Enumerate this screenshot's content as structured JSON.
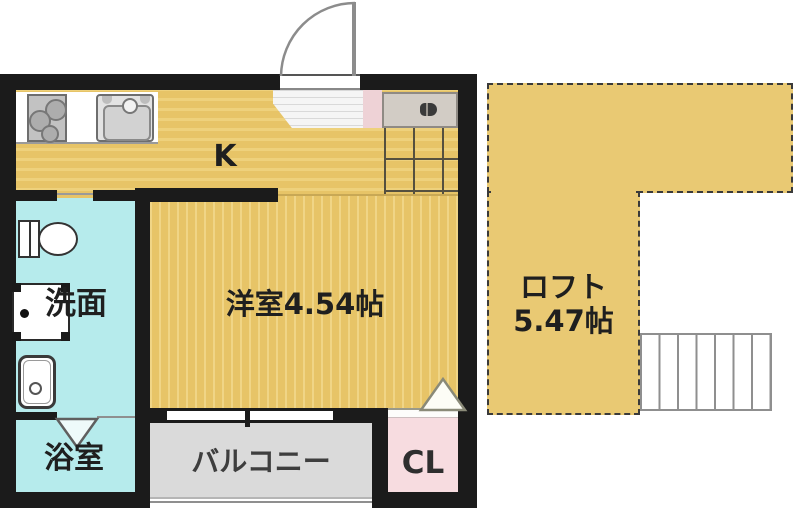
{
  "rooms": {
    "kitchen": {
      "label": "K"
    },
    "main_room": {
      "label": "洋室4.54帖"
    },
    "loft": {
      "label_line1": "ロフト",
      "label_line2": "5.47帖"
    },
    "washroom": {
      "label": "洗面"
    },
    "bathroom": {
      "label": "浴室"
    },
    "balcony": {
      "label": "バルコニー"
    },
    "closet": {
      "label": "CL"
    }
  },
  "icons": {
    "stove": "three-burner-circles",
    "sink": "rounded-basin-with-faucet",
    "toilet": "tank-and-bowl",
    "washbasin": "vanity-square-with-drain",
    "washing_machine": "rounded-square-with-dial",
    "shoe_cabinet": "gray-box-with-shoes",
    "entry_door": "quarter-circle-swing",
    "loft_ladder": "rung-lines",
    "bath_folding_door": "v-mark",
    "closet_door": "triangle-mark"
  },
  "colors": {
    "floor_yellow": "#e8c76b",
    "loft_yellow": "#e9c973",
    "washroom_cyan": "#b6ebec",
    "balcony_gray": "#dadada",
    "closet_pink": "#f7dce0",
    "entry_pink": "#eed2d6",
    "shoebox_gray": "#d2ccc5",
    "wall_black": "#1b1b1b"
  }
}
